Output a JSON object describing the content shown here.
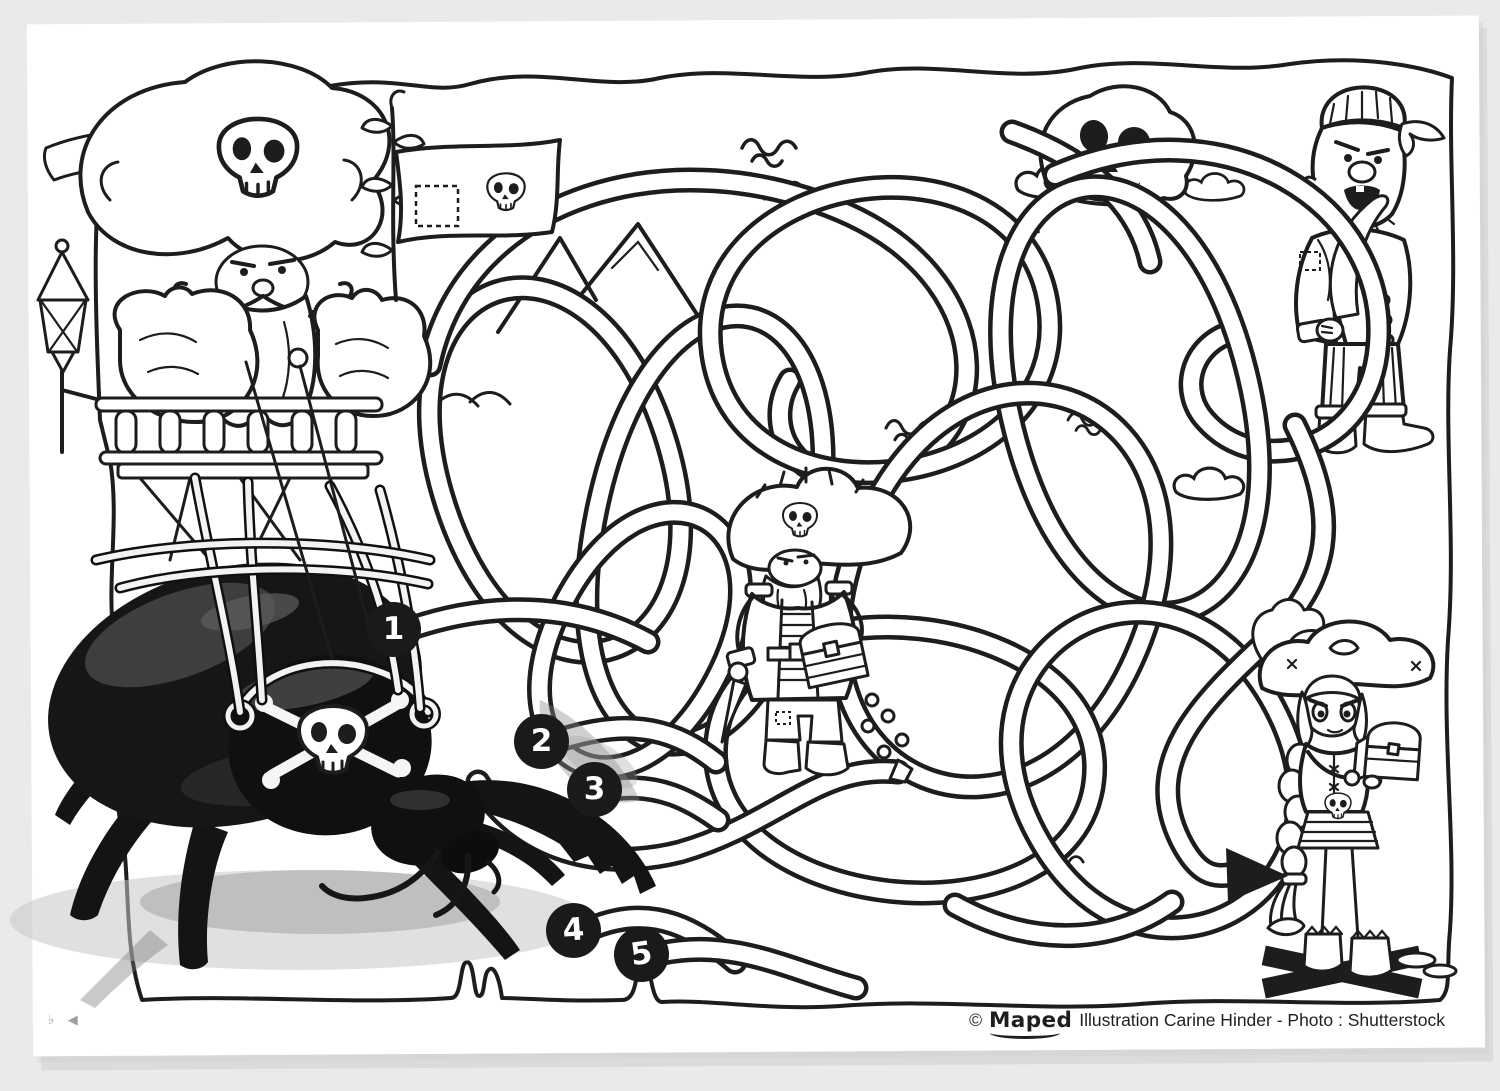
{
  "page": {
    "background_color": "#e9eaea",
    "paper_color": "#ffffff",
    "ink_color": "#1d1d1d",
    "shadow_color": "#bfbfbf"
  },
  "maze": {
    "start_markers": [
      {
        "label": "1"
      },
      {
        "label": "2"
      },
      {
        "label": "3"
      },
      {
        "label": "4"
      },
      {
        "label": "5"
      }
    ],
    "marker_background": "#1a1a1a",
    "marker_text_color": "#ffffff"
  },
  "footer": {
    "copyright": "©",
    "brand": "Maped",
    "credit": "Illustration Carine Hinder - Photo : Shutterstock"
  },
  "corner_marks": "♭ ◀",
  "icons": {
    "skull-icon": "☠",
    "crossbones-icon": "☠",
    "jolly-roger-flag-icon": "⚑",
    "finish-arrow-icon": "➤",
    "x-marks-the-spot-icon": "✕",
    "coin-icon": "●",
    "wave-icon": "≈",
    "cloud-icon": "☁",
    "mountain-icon": "△",
    "lantern-icon": "◇"
  },
  "scene": {
    "figures": [
      "pirate-aeronaut-in-balloon-basket",
      "giant-beetle-photo-with-skull-cap",
      "pirate-captain-with-treasure-chest",
      "skull-rock-in-clouds",
      "pirate-with-cutlass",
      "pirate-girl-with-treasure-chest"
    ]
  }
}
